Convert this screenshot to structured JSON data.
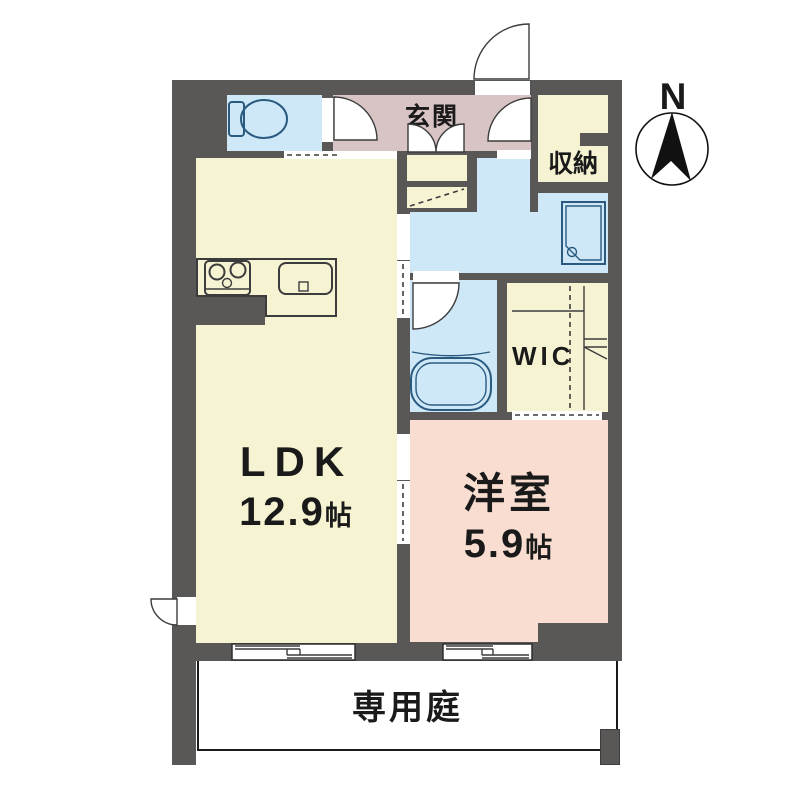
{
  "compass": {
    "north": "N"
  },
  "rooms": {
    "genkan": {
      "label": "玄関"
    },
    "storage": {
      "label": "収納"
    },
    "wic": {
      "label": "WIC"
    },
    "ldk": {
      "name": "LDK",
      "size": "12.9",
      "unit": "帖"
    },
    "western": {
      "name": "洋室",
      "size": "5.9",
      "unit": "帖"
    },
    "garden": {
      "label": "専用庭"
    }
  },
  "icons": {
    "compass": "north-arrow-in-circle",
    "toilet": "toilet-plan-symbol",
    "bathtub": "bathtub-plan-symbol",
    "stove": "three-burner-stove-symbol",
    "sink": "kitchen-sink-symbol",
    "washer": "washing-machine-pan-symbol",
    "windows": "sliding-window-symbol",
    "doors": "door-swing-arc-symbol"
  },
  "colors": {
    "wall": "#5a5757",
    "room_cream": "#f6f3d3",
    "room_blue": "#cfe8f7",
    "genkan_pink": "#d8c4c5",
    "west_pink": "#f8ddd0",
    "fixture": "#2a5a80"
  }
}
